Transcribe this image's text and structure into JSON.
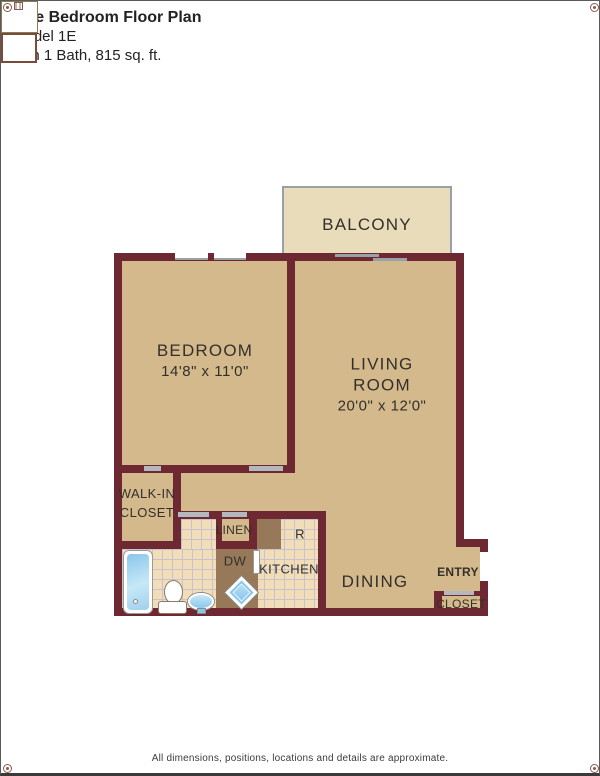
{
  "header": {
    "title": "One Bedroom Floor Plan",
    "model": "Model 1E",
    "details": "with 1 Bath, 815 sq. ft."
  },
  "plan": {
    "balcony": "BALCONY",
    "bedroom": {
      "name": "BEDROOM",
      "dims": "14'8\" x 11'0\""
    },
    "living": {
      "line1": "LIVING",
      "line2": "ROOM",
      "dims": "20'0\" x 12'0\""
    },
    "walk_in": {
      "line1": "WALK-IN",
      "line2": "CLOSET"
    },
    "linen": "LINEN",
    "dishwasher": "DW",
    "kitchen": "KITCHEN",
    "dining": "DINING",
    "entry": "ENTRY",
    "closet": "CLOSET",
    "refrigerator": "R"
  },
  "footer": {
    "disclaimer": "All dimensions, positions, locations and details are approximate."
  },
  "colors": {
    "wall": "#6e2831",
    "floor": "#d4b98c",
    "balcony": "#e9dcba",
    "tile": "#f2ddb9",
    "counter": "#97795a"
  }
}
